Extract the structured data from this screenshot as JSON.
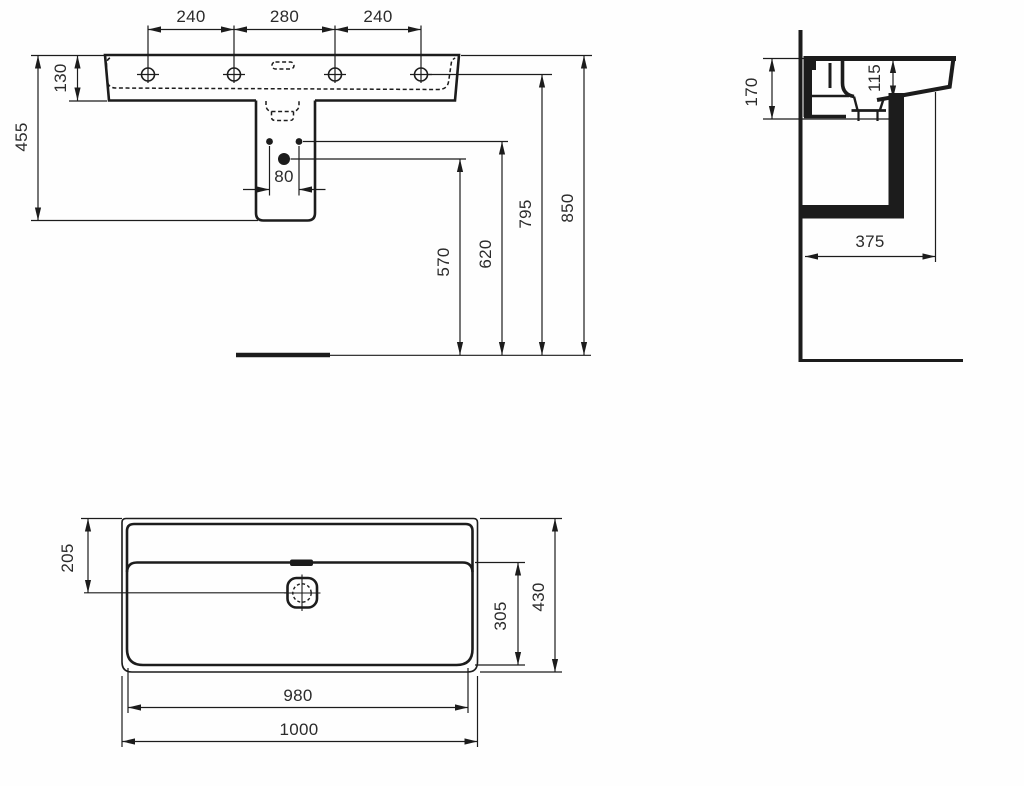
{
  "drawing": {
    "type": "technical-dimension-drawing",
    "subject": "wall-hung washbasin with shroud, three orthographic views",
    "background_color": "#fefefe",
    "line_color": "#1c1c1c",
    "views": [
      "front-elevation",
      "side-section",
      "plan"
    ]
  },
  "dims": {
    "front": {
      "tap_left": "240",
      "tap_center": "280",
      "tap_right": "240",
      "basin_height": "130",
      "total_height_with_shroud": "455",
      "fixing_hole_spacing": "80",
      "h_drain": "570",
      "h_fixing": "620",
      "h_deck": "795",
      "h_rim": "850"
    },
    "side": {
      "back_height": "170",
      "bowl_depth": "115",
      "wall_to_trap": "375"
    },
    "plan": {
      "rim_to_drain": "205",
      "drain_to_front": "305",
      "depth": "430",
      "inner_width": "980",
      "width": "1000"
    }
  }
}
